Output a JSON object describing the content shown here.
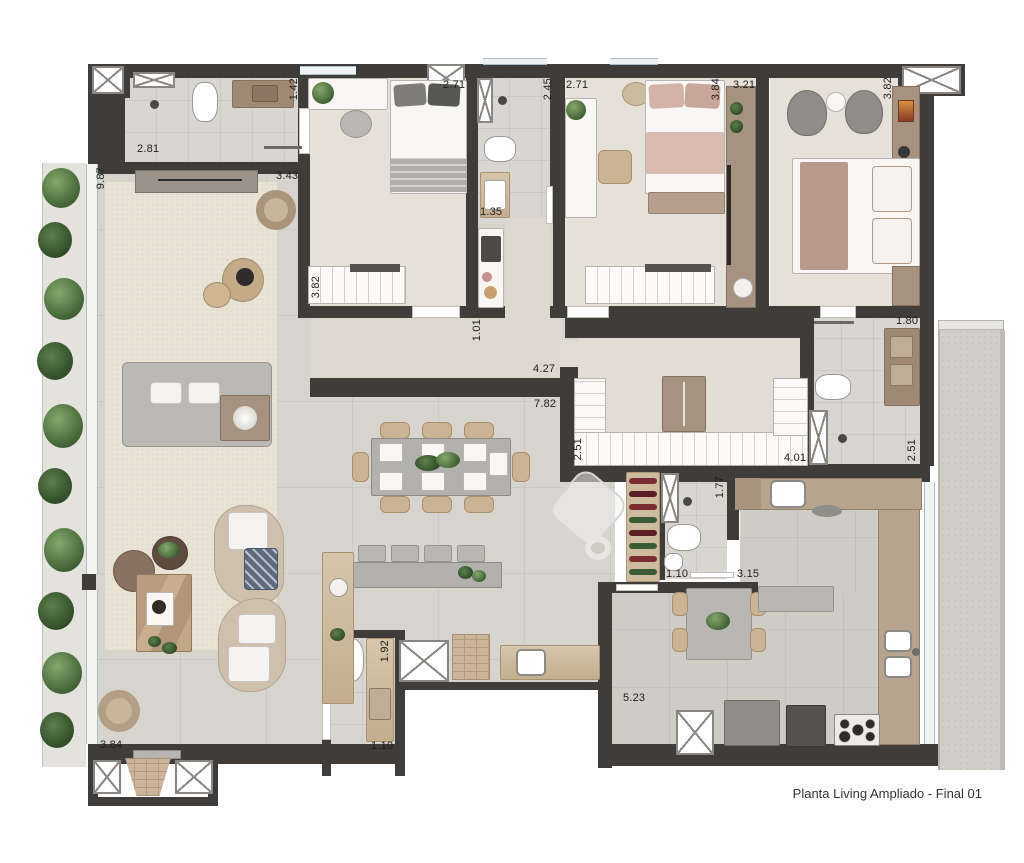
{
  "title": "Planta Living Ampliado - Final 01",
  "dimensions": [
    {
      "text": "2.81",
      "x": 137,
      "y": 143,
      "v": false
    },
    {
      "text": "1.42",
      "x": 288,
      "y": 78,
      "v": true
    },
    {
      "text": "2.71",
      "x": 443,
      "y": 79,
      "v": false
    },
    {
      "text": "2.45",
      "x": 542,
      "y": 78,
      "v": true
    },
    {
      "text": "2.71",
      "x": 566,
      "y": 79,
      "v": false
    },
    {
      "text": "3.84",
      "x": 710,
      "y": 78,
      "v": true
    },
    {
      "text": "3.21",
      "x": 733,
      "y": 79,
      "v": false
    },
    {
      "text": "3.82",
      "x": 882,
      "y": 77,
      "v": true
    },
    {
      "text": "9.87",
      "x": 95,
      "y": 167,
      "v": true
    },
    {
      "text": "3.43",
      "x": 276,
      "y": 170,
      "v": false
    },
    {
      "text": "3.82",
      "x": 310,
      "y": 276,
      "v": true
    },
    {
      "text": "1.35",
      "x": 480,
      "y": 206,
      "v": false
    },
    {
      "text": "1.01",
      "x": 471,
      "y": 319,
      "v": true
    },
    {
      "text": "4.27",
      "x": 533,
      "y": 363,
      "v": false
    },
    {
      "text": "7.82",
      "x": 534,
      "y": 398,
      "v": false
    },
    {
      "text": "2.51",
      "x": 572,
      "y": 438,
      "v": true
    },
    {
      "text": "4.01",
      "x": 784,
      "y": 452,
      "v": false
    },
    {
      "text": "1.80",
      "x": 896,
      "y": 315,
      "v": false
    },
    {
      "text": "2.51",
      "x": 906,
      "y": 439,
      "v": true
    },
    {
      "text": "1.77",
      "x": 714,
      "y": 476,
      "v": true
    },
    {
      "text": "1.10",
      "x": 666,
      "y": 568,
      "v": false
    },
    {
      "text": "3.15",
      "x": 737,
      "y": 568,
      "v": false
    },
    {
      "text": "1.92",
      "x": 379,
      "y": 640,
      "v": true
    },
    {
      "text": "1.10",
      "x": 371,
      "y": 740,
      "v": false
    },
    {
      "text": "5.23",
      "x": 623,
      "y": 692,
      "v": false
    },
    {
      "text": "3.84",
      "x": 100,
      "y": 739,
      "v": false
    }
  ],
  "colors": {
    "wall": "#3f3c39",
    "floor_living": "#d7d4ce",
    "floor_bedroom": "#e6e1d8",
    "floor_bath": "#d9d6d1",
    "wood": "#cdbb9e",
    "kitchen_counter": "#b7a48f",
    "plant_green": "#4a6b3c",
    "bed_pink": "#d9bcb0",
    "sofa_gray": "#bbb9b6",
    "glass_blue": "#a9c0c8",
    "label_text": "#1f1e1c"
  }
}
